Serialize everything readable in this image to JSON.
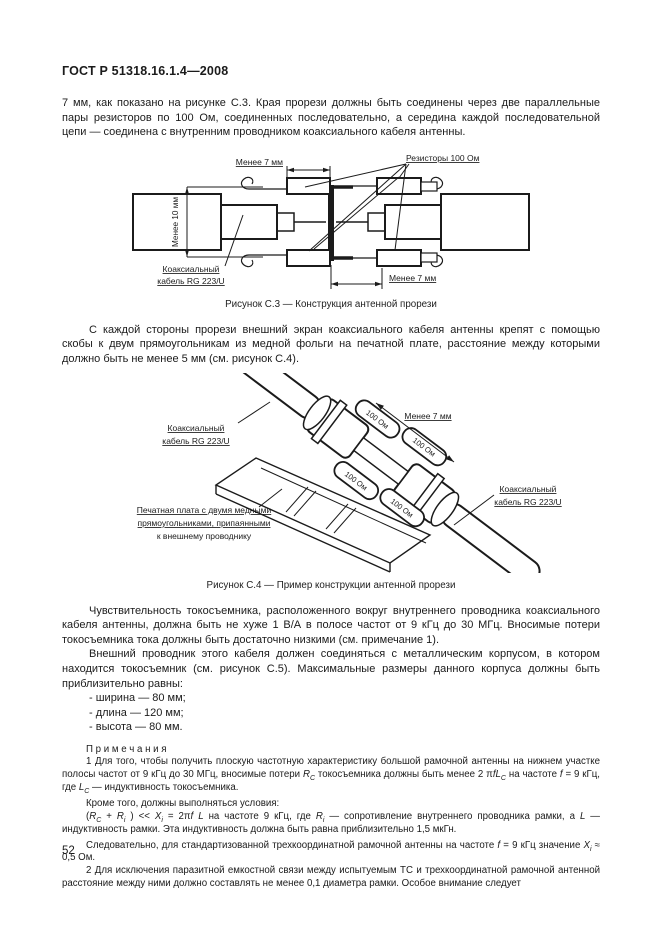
{
  "header": {
    "title": "ГОСТ Р 51318.16.1.4—2008"
  },
  "intro": "7 мм, как показано на рисунке С.3. Края прорези должны быть соединены через две параллельные пары резисторов по 100 Ом, соединенных последовательно, а середина каждой последовательной цепи — соединена с внутренним проводником коаксиального кабеля антенны.",
  "fig_c3": {
    "caption": "Рисунок С.3 — Конструкция антенной прорези",
    "label_less7_top": "Менее 7 мм",
    "label_resistors": "Резисторы 100 Ом",
    "label_less10": "Менее 10 мм",
    "label_cable_line1": "Коаксиальный",
    "label_cable_line2": "кабель RG 223/U",
    "label_less7_bottom": "Менее 7 мм"
  },
  "para_c4": "С каждой стороны прорези внешний экран коаксиального кабеля антенны крепят с помощью скобы к двум прямоугольникам из медной фольги на печатной плате, расстояние между которыми должно быть не менее 5 мм (см. рисунок С.4).",
  "fig_c4": {
    "caption": "Рисунок С.4 — Пример конструкции антенной прорези",
    "label_cable_left_line1": "Коаксиальный",
    "label_cable_left_line2": "кабель RG 223/U",
    "label_less7": "Менее 7 мм",
    "label_cable_right_line1": "Коаксиальный",
    "label_cable_right_line2": "кабель RG 223/U",
    "label_pcb_line1": "Печатная плата с двумя медными",
    "label_pcb_line2": "прямоугольниками, припаянными",
    "label_pcb_line3": "к внешнему проводнику",
    "resistor_label": "100 Ом"
  },
  "body": {
    "p1": "Чувствительность токосъемника, расположенного вокруг внутреннего проводника коаксиального кабеля антенны, должна быть не хуже 1 В/А в полосе частот от 9 кГц до 30 МГц. Вносимые потери токосъемника тока должны быть достаточно низкими (см. примечание 1).",
    "p2": "Внешний проводник этого кабеля должен соединяться с металлическим корпусом, в котором находится токосъемник (см. рисунок С.5). Максимальные размеры данного корпуса должны быть приблизительно равны:",
    "list": [
      "- ширина — 80 мм;",
      "- длина — 120 мм;",
      "- высота — 80 мм."
    ]
  },
  "notes": {
    "heading": "П р и м е ч а н и я",
    "n1_html": "1 Для того, чтобы получить плоскую частотную характеристику большой рамочной антенны на нижнем участке полосы частот от 9 кГц до 30 МГц, вносимые потери <i>R</i><sub><i>C</i></sub> токосъемника должны быть менее 2 π<i>fL</i><sub><i>C</i></sub> на частоте <i>f</i> = 9 кГц, где <i>L</i><sub><i>C</i></sub> — индуктивность токосъемника.",
    "n1b": "Кроме того, должны выполняться условия:",
    "n1c_html": "(<i>R</i><sub><i>C</i></sub> + <i>R</i><sub><i>i</i></sub> ) &lt;&lt; <i>X</i><sub><i>i</i></sub> = 2π<i>f</i> <i>L</i> на частоте 9 кГц, где <i>R</i><sub><i>i</i></sub> — сопротивление внутреннего проводника рамки, а <i>L</i> — индуктивность рамки. Эта индуктивность должна быть равна приблизительно 1,5 мкГн.",
    "n1d_html": "Следовательно, для стандартизованной трехкоординатной рамочной антенны на частоте <i>f</i> = 9 кГц значение <i>X</i><sub><i>i</i></sub> ≈ 0,5 Ом.",
    "n2": "2 Для исключения паразитной емкостной связи между испытуемым ТС и трехкоординатной рамочной антенной расстояние между ними должно составлять не менее 0,1 диаметра рамки. Особое внимание следует"
  },
  "footer": {
    "page_number": "52"
  }
}
